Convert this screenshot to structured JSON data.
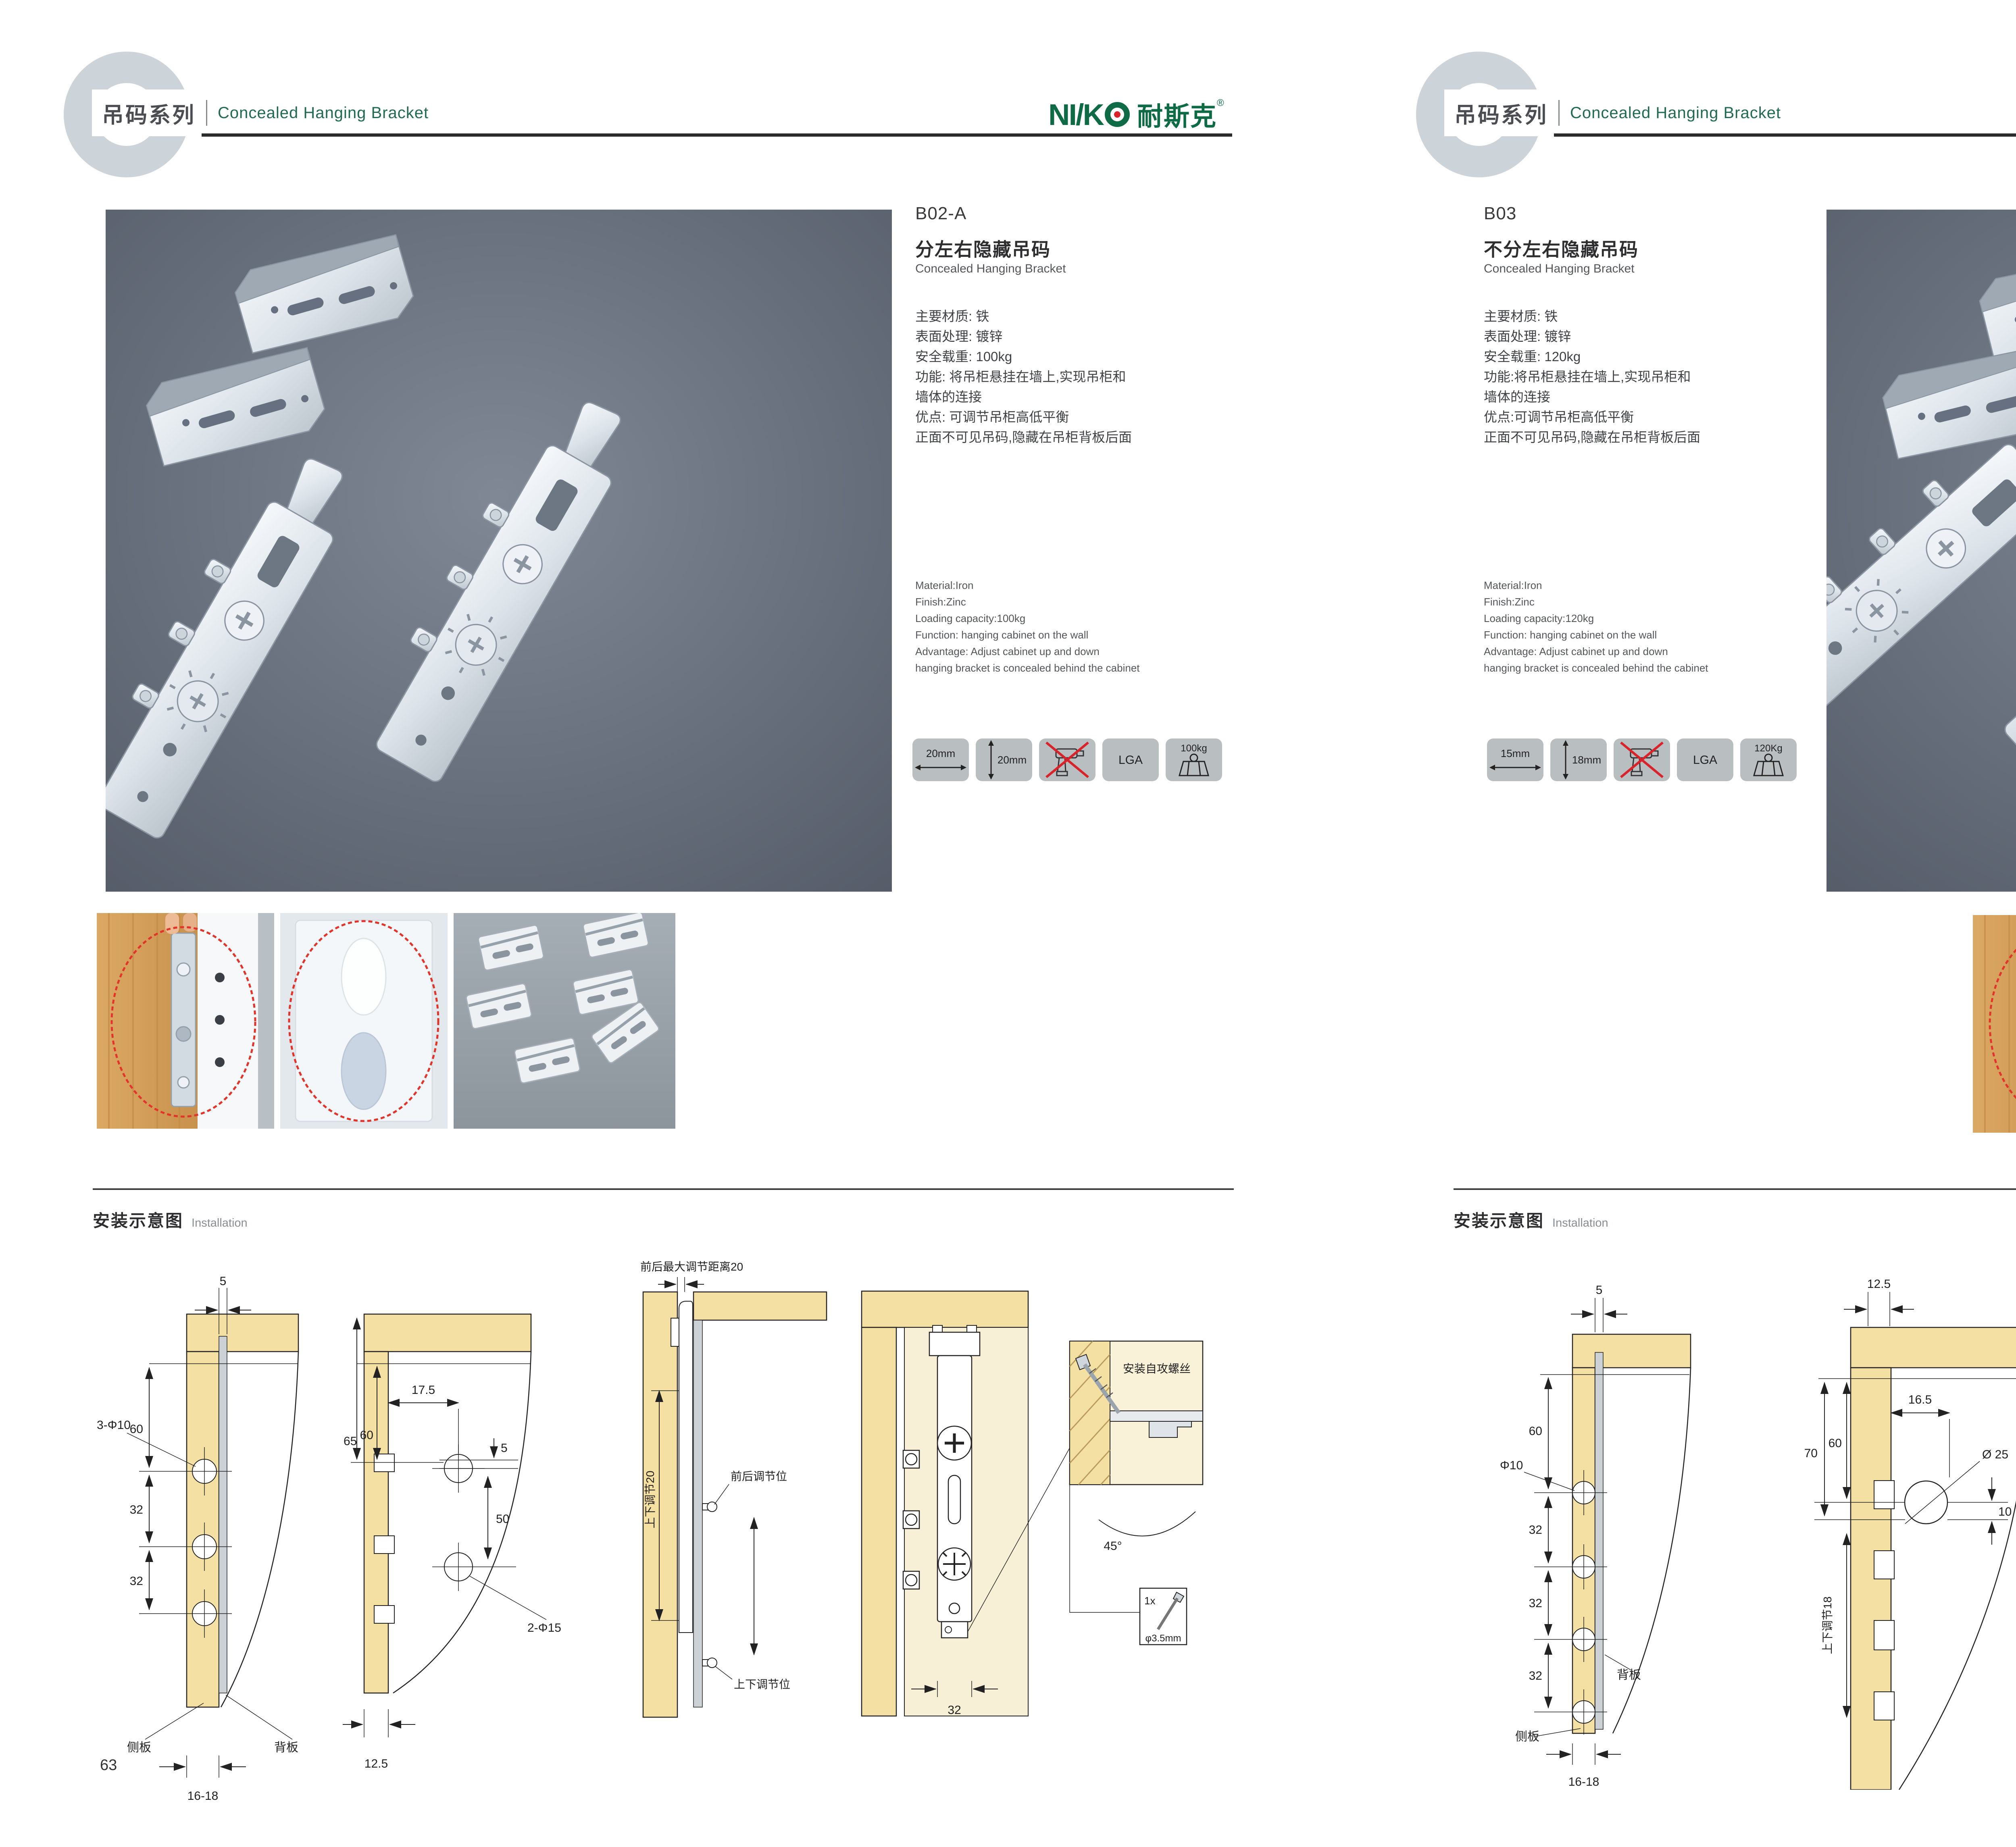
{
  "brand": {
    "latin": "NI/K",
    "cn": "耐斯克",
    "reg": "®",
    "green": "#0f6b45",
    "red": "#d8232a"
  },
  "header": {
    "series_cn": "吊码系列",
    "series_en": "Concealed Hanging Bracket"
  },
  "section": {
    "install_cn": "安装示意图",
    "install_en": "Installation"
  },
  "left": {
    "page_number": "63",
    "code": "B02-A",
    "name_cn": "分左右隐藏吊码",
    "name_en": "Concealed Hanging Bracket",
    "specs_cn": [
      "主要材质: 铁",
      "表面处理: 镀锌",
      "安全载重: 100kg",
      "功能: 将吊柜悬挂在墙上,实现吊柜和",
      "墙体的连接",
      "优点: 可调节吊柜高低平衡",
      "正面不可见吊码,隐藏在吊柜背板后面"
    ],
    "specs_en": [
      "Material:Iron",
      "Finish:Zinc",
      "Loading capacity:100kg",
      "Function: hanging cabinet on the wall",
      "Advantage: Adjust cabinet up and down",
      "hanging bracket is concealed behind the cabinet"
    ],
    "icons": {
      "w": "20mm",
      "h": "20mm",
      "cert": "LGA",
      "load": "100kg"
    },
    "d1": {
      "dim_top": "5",
      "dim_60": "60",
      "hole_label": "3-Φ10",
      "dim_32a": "32",
      "dim_32b": "32",
      "side_panel": "侧板",
      "back_panel": "背板",
      "dim_bottom": "16-18"
    },
    "d2": {
      "dim_65": "65",
      "dim_60": "60",
      "dim_175": "17.5",
      "dim_5": "5",
      "dim_50": "50",
      "hole_label": "2-Φ15",
      "dim_bottom": "12.5"
    },
    "d3": {
      "dim_top": "前后最大调节距离20",
      "dim_vert": "上下调节20",
      "label_fb": "前后调节位",
      "label_ud": "上下调节位"
    },
    "d4": {
      "dim_32": "32"
    },
    "d5": {
      "label_screw": "安装自攻螺丝",
      "angle": "45°",
      "qty": "1x",
      "dia": "φ3.5mm"
    }
  },
  "right": {
    "page_number": "64",
    "code": "B03",
    "name_cn": "不分左右隐藏吊码",
    "name_en": "Concealed Hanging Bracket",
    "specs_cn": [
      "主要材质: 铁",
      "表面处理: 镀锌",
      "安全载重: 120kg",
      "功能:将吊柜悬挂在墙上,实现吊柜和",
      "墙体的连接",
      "优点:可调节吊柜高低平衡",
      "正面不可见吊码,隐藏在吊柜背板后面"
    ],
    "specs_en": [
      "Material:Iron",
      "Finish:Zinc",
      "Loading capacity:120kg",
      "Function: hanging cabinet on the wall",
      "Advantage: Adjust cabinet up and down",
      "hanging bracket is concealed behind the cabinet"
    ],
    "icons": {
      "w": "15mm",
      "h": "18mm",
      "cert": "LGA",
      "load": "120Kg"
    },
    "d1": {
      "dim_top": "5",
      "dim_60": "60",
      "hole_label": "Φ10",
      "dim_32a": "32",
      "dim_32b": "32",
      "dim_32c": "32",
      "back_panel": "背板",
      "side_panel": "侧板",
      "dim_bottom": "16-18"
    },
    "d2": {
      "dim_top": "12.5",
      "dim_70": "70",
      "dim_60": "60",
      "dim_165": "16.5",
      "hole_label": "Ø 25",
      "dim_10": "10",
      "dim_vert": "上下调节18"
    },
    "d3": {
      "dim_top": "16.5",
      "dim_125": "12.5",
      "dim_10": "10",
      "hole_label": "ø25",
      "label_lock": "锁紧状态"
    },
    "d4": {
      "label_screw": "安装自攻螺丝",
      "angle": "45°",
      "qty": "1x",
      "dia": "φ3.5mm"
    }
  }
}
